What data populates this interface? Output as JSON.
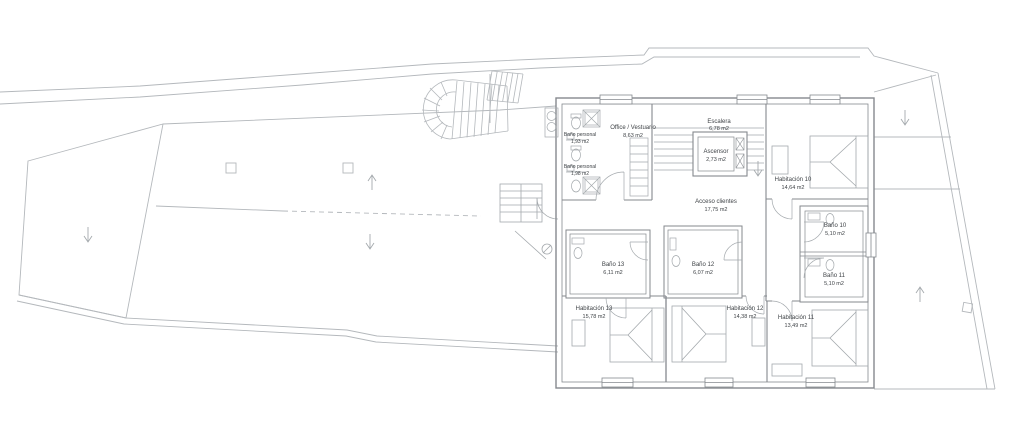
{
  "plan": {
    "drawing_type": "floor-plan",
    "rooms": [
      {
        "id": "office-vestuario",
        "name": "Office / Vestuario",
        "area": "8,63 m2"
      },
      {
        "id": "bano-personal-1",
        "name": "Baño personal",
        "area": "1,93 m2"
      },
      {
        "id": "bano-personal-2",
        "name": "Baño personal",
        "area": "1,98 m2"
      },
      {
        "id": "escalera",
        "name": "Escalera",
        "area": "6,78 m2"
      },
      {
        "id": "ascensor",
        "name": "Ascensor",
        "area": "2,73 m2"
      },
      {
        "id": "acceso-clientes",
        "name": "Acceso clientes",
        "area": "17,75 m2"
      },
      {
        "id": "habitacion-10",
        "name": "Habitación 10",
        "area": "14,64 m2"
      },
      {
        "id": "bano-10",
        "name": "Baño 10",
        "area": "5,10 m2"
      },
      {
        "id": "bano-11",
        "name": "Baño 11",
        "area": "5,10 m2"
      },
      {
        "id": "habitacion-11",
        "name": "Habitación 11",
        "area": "13,49 m2"
      },
      {
        "id": "habitacion-12",
        "name": "Habitación 12",
        "area": "14,38 m2"
      },
      {
        "id": "bano-12",
        "name": "Baño 12",
        "area": "6,07 m2"
      },
      {
        "id": "bano-13",
        "name": "Baño 13",
        "area": "6,11 m2"
      },
      {
        "id": "habitacion-13",
        "name": "Habitación 13",
        "area": "15,78 m2"
      }
    ],
    "arrows": [
      {
        "id": "left-terrace-arrow",
        "direction": "down"
      },
      {
        "id": "mid-terrace-arrow-up",
        "direction": "up"
      },
      {
        "id": "mid-terrace-arrow-down",
        "direction": "down"
      },
      {
        "id": "right-terrace-arrow-down",
        "direction": "down"
      },
      {
        "id": "right-terrace-arrow-up",
        "direction": "up"
      },
      {
        "id": "stair-arrow-down",
        "direction": "down"
      }
    ],
    "colors": {
      "background": "#ffffff",
      "site_line": "#b4b8bc",
      "wall_line": "#85898e",
      "fixture_line": "#a4a9ad",
      "label_text": "#3f4347"
    }
  }
}
